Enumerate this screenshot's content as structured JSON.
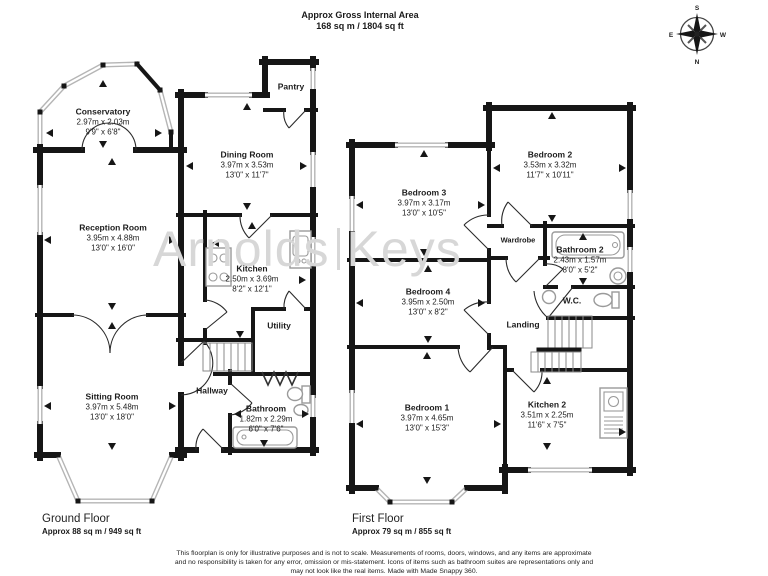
{
  "header": {
    "title": "Approx Gross Internal Area",
    "subtitle": "168 sq m / 1804 sq ft"
  },
  "compass": {
    "top": "S",
    "bottom": "N",
    "left": "E",
    "right": "W"
  },
  "watermark": {
    "left": "Arnolds",
    "right": "Keys"
  },
  "rooms": {
    "conservatory": {
      "name": "Conservatory",
      "metric": "2.97m x 2.03m",
      "imperial": "9'9\" x 6'8\""
    },
    "reception": {
      "name": "Reception Room",
      "metric": "3.95m x 4.88m",
      "imperial": "13'0\" x 16'0\""
    },
    "dining": {
      "name": "Dining Room",
      "metric": "3.97m x 3.53m",
      "imperial": "13'0\" x 11'7\""
    },
    "pantry": {
      "name": "Pantry"
    },
    "kitchen": {
      "name": "Kitchen",
      "metric": "2.50m x 3.69m",
      "imperial": "8'2\" x 12'1\""
    },
    "utility": {
      "name": "Utility"
    },
    "hallway": {
      "name": "Hallway"
    },
    "sitting": {
      "name": "Sitting Room",
      "metric": "3.97m x 5.48m",
      "imperial": "13'0\" x 18'0\""
    },
    "bathroom": {
      "name": "Bathroom",
      "metric": "1.82m x 2.29m",
      "imperial": "6'0\" x 7'6\""
    },
    "bedroom3": {
      "name": "Bedroom 3",
      "metric": "3.97m x 3.17m",
      "imperial": "13'0\" x 10'5\""
    },
    "bedroom2": {
      "name": "Bedroom 2",
      "metric": "3.53m x 3.32m",
      "imperial": "11'7\" x 10'11\""
    },
    "wardrobe": {
      "name": "Wardrobe"
    },
    "bathroom2": {
      "name": "Bathroom 2",
      "metric": "2.43m x 1.57m",
      "imperial": "8'0\" x 5'2\""
    },
    "wc": {
      "name": "W.C."
    },
    "landing": {
      "name": "Landing"
    },
    "bedroom4": {
      "name": "Bedroom 4",
      "metric": "3.95m x 2.50m",
      "imperial": "13'0\" x 8'2\""
    },
    "bedroom1": {
      "name": "Bedroom 1",
      "metric": "3.97m x 4.65m",
      "imperial": "13'0\" x 15'3\""
    },
    "kitchen2": {
      "name": "Kitchen 2",
      "metric": "3.51m x 2.25m",
      "imperial": "11'6\" x 7'5\""
    }
  },
  "floors": {
    "ground": {
      "label": "Ground Floor",
      "area": "Approx 88 sq m / 949 sq ft"
    },
    "first": {
      "label": "First Floor",
      "area": "Approx 79 sq m / 855 sq ft"
    }
  },
  "disclaimer": {
    "line1": "This floorplan is only for illustrative purposes and is not to scale. Measurements of rooms, doors, windows, and any items are approximate",
    "line2": "and no responsibility is taken for any error, omission or mis-statement. Icons of items such as bathroom suites are representations only and",
    "line3": "may not look like the real items. Made with Made Snappy 360."
  }
}
